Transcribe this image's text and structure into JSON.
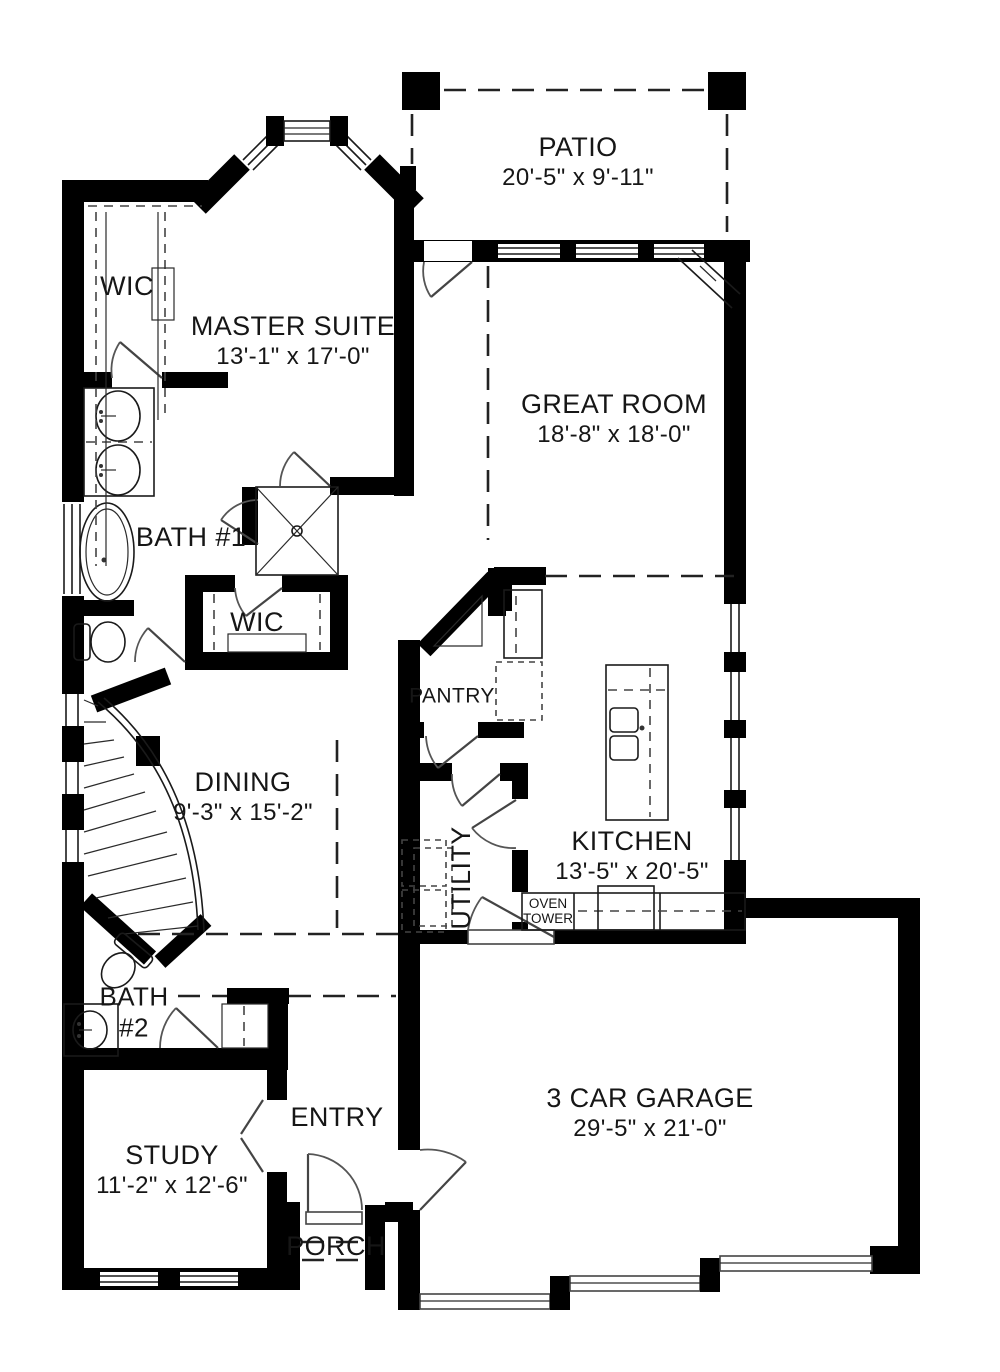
{
  "title": "Single-story house floor plan",
  "colors": {
    "wall": "#000000",
    "line": "#1a1a1a",
    "background": "#ffffff"
  },
  "rooms": {
    "patio": {
      "name": "PATIO",
      "dims": "20'-5\" x 9'-11\""
    },
    "master_suite": {
      "name": "MASTER SUITE",
      "dims": "13'-1\" x 17'-0\""
    },
    "great_room": {
      "name": "GREAT ROOM",
      "dims": "18'-8\" x 18'-0\""
    },
    "wic_1": {
      "name": "WIC"
    },
    "bath_1": {
      "name": "BATH #1"
    },
    "wic_2": {
      "name": "WIC"
    },
    "pantry": {
      "name": "PANTRY"
    },
    "dining": {
      "name": "DINING",
      "dims": "9'-3\" x 15'-2\""
    },
    "kitchen": {
      "name": "KITCHEN",
      "dims": "13'-5\" x 20'-5\""
    },
    "utility": {
      "name": "UTILITY"
    },
    "oven_tower": {
      "name": "OVEN TOWER"
    },
    "bath_2": {
      "name": "BATH #2"
    },
    "entry": {
      "name": "ENTRY"
    },
    "study": {
      "name": "STUDY",
      "dims": "11'-2\" x 12'-6\""
    },
    "porch": {
      "name": "PORCH"
    },
    "garage": {
      "name": "3 CAR GARAGE",
      "dims": "29'-5\" x 21'-0\""
    }
  }
}
